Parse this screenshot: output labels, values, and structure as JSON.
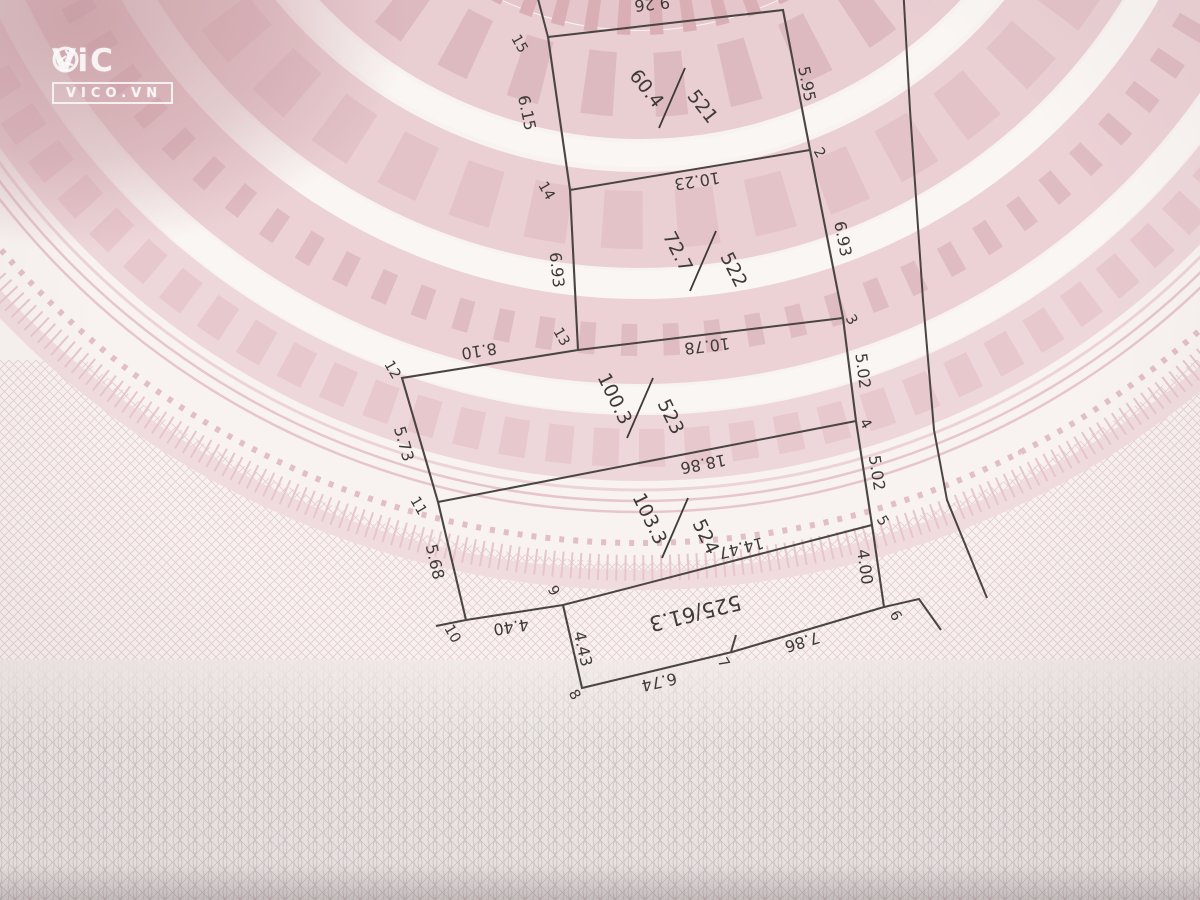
{
  "watermark": {
    "brand_prefix": "ViC",
    "site": "VICO.VN"
  },
  "colors": {
    "ink": "#4a4542",
    "label": "#3e3a37",
    "paper": "#f7f2f0",
    "band_dark": "#c79aa1",
    "band_mid": "#ecd3d6",
    "band_deep": "#e5c6cb",
    "mesh_pink": "#e3c6ca",
    "mesh_gray": "#cdc2c4",
    "watermark": "#ffffff"
  },
  "diagram": {
    "outline": [
      [
        548,
        37
      ],
      [
        783,
        10
      ],
      [
        810,
        150
      ],
      [
        843,
        318
      ],
      [
        856,
        421
      ],
      [
        872,
        525
      ],
      [
        884,
        607
      ],
      [
        732,
        652
      ],
      [
        582,
        688
      ],
      [
        563,
        605
      ],
      [
        466,
        620
      ],
      [
        438,
        502
      ],
      [
        402,
        378
      ],
      [
        578,
        350
      ],
      [
        570,
        190
      ]
    ],
    "extra_lines": [
      {
        "name": "boundary-extension-top",
        "points": [
          [
            548,
            37
          ],
          [
            533,
            -20
          ]
        ]
      },
      {
        "name": "divider-521-522",
        "points": [
          [
            570,
            190
          ],
          [
            810,
            150
          ]
        ]
      },
      {
        "name": "divider-522-523",
        "points": [
          [
            578,
            350
          ],
          [
            843,
            318
          ]
        ]
      },
      {
        "name": "divider-523-524",
        "points": [
          [
            438,
            502
          ],
          [
            856,
            421
          ]
        ]
      },
      {
        "name": "divider-524-525",
        "points": [
          [
            563,
            605
          ],
          [
            872,
            525
          ]
        ]
      },
      {
        "name": "tick-vertex-10",
        "points": [
          [
            466,
            620
          ],
          [
            436,
            626
          ]
        ]
      },
      {
        "name": "tick-vertex-7",
        "points": [
          [
            731,
            652
          ],
          [
            736,
            635
          ]
        ]
      },
      {
        "name": "boundary-dogleg-6",
        "points": [
          [
            884,
            607
          ],
          [
            919,
            599
          ],
          [
            941,
            630
          ]
        ]
      },
      {
        "name": "road-boundary",
        "points": [
          [
            903,
            -15
          ],
          [
            910,
            110
          ],
          [
            923,
            300
          ],
          [
            934,
            430
          ],
          [
            947,
            500
          ],
          [
            987,
            598
          ]
        ]
      }
    ],
    "parcels": [
      {
        "id": "521",
        "area": "60.4",
        "cx": 672,
        "cy": 98,
        "rot": 52
      },
      {
        "id": "522",
        "area": "72.7",
        "cx": 703,
        "cy": 261,
        "rot": 63
      },
      {
        "id": "523",
        "area": "100.3",
        "cx": 640,
        "cy": 408,
        "rot": 64
      },
      {
        "id": "524",
        "area": "103.3",
        "cx": 675,
        "cy": 528,
        "rot": 64
      }
    ],
    "strip_label": {
      "text": "525/61.3",
      "x": 695,
      "y": 612,
      "rot": 166,
      "size": 21
    },
    "edge_labels": [
      {
        "t": "9.26",
        "x": 652,
        "y": 3,
        "r": 174
      },
      {
        "t": "6.15",
        "x": 526,
        "y": 113,
        "r": 78
      },
      {
        "t": "5.95",
        "x": 806,
        "y": 84,
        "r": 79
      },
      {
        "t": "10.23",
        "x": 697,
        "y": 180,
        "r": 171
      },
      {
        "t": "6.93",
        "x": 556,
        "y": 270,
        "r": 84
      },
      {
        "t": "6.93",
        "x": 842,
        "y": 239,
        "r": 79
      },
      {
        "t": "10.78",
        "x": 707,
        "y": 345,
        "r": 173
      },
      {
        "t": "8.10",
        "x": 479,
        "y": 350,
        "r": 171
      },
      {
        "t": "5.02",
        "x": 862,
        "y": 371,
        "r": 83
      },
      {
        "t": "5.73",
        "x": 403,
        "y": 444,
        "r": 74
      },
      {
        "t": "18.86",
        "x": 703,
        "y": 463,
        "r": 169
      },
      {
        "t": "5.02",
        "x": 876,
        "y": 473,
        "r": 81
      },
      {
        "t": "14.47",
        "x": 741,
        "y": 547,
        "r": 166
      },
      {
        "t": "5.68",
        "x": 434,
        "y": 562,
        "r": 77
      },
      {
        "t": "4.00",
        "x": 864,
        "y": 567,
        "r": 82
      },
      {
        "t": "4.40",
        "x": 511,
        "y": 626,
        "r": 171
      },
      {
        "t": "4.43",
        "x": 582,
        "y": 649,
        "r": 77
      },
      {
        "t": "6.74",
        "x": 659,
        "y": 681,
        "r": 167
      },
      {
        "t": "7.86",
        "x": 802,
        "y": 641,
        "r": 163
      }
    ],
    "vertex_labels": [
      {
        "t": "15",
        "x": 519,
        "y": 44
      },
      {
        "t": "14",
        "x": 546,
        "y": 191
      },
      {
        "t": "13",
        "x": 561,
        "y": 337
      },
      {
        "t": "12",
        "x": 392,
        "y": 370
      },
      {
        "t": "11",
        "x": 418,
        "y": 506
      },
      {
        "t": "10",
        "x": 452,
        "y": 634
      },
      {
        "t": "9",
        "x": 553,
        "y": 591
      },
      {
        "t": "8",
        "x": 574,
        "y": 695
      },
      {
        "t": "7",
        "x": 723,
        "y": 663
      },
      {
        "t": "6",
        "x": 895,
        "y": 616
      },
      {
        "t": "5",
        "x": 882,
        "y": 521
      },
      {
        "t": "4",
        "x": 865,
        "y": 424
      },
      {
        "t": "3",
        "x": 851,
        "y": 320
      },
      {
        "t": "2",
        "x": 819,
        "y": 153
      }
    ]
  }
}
